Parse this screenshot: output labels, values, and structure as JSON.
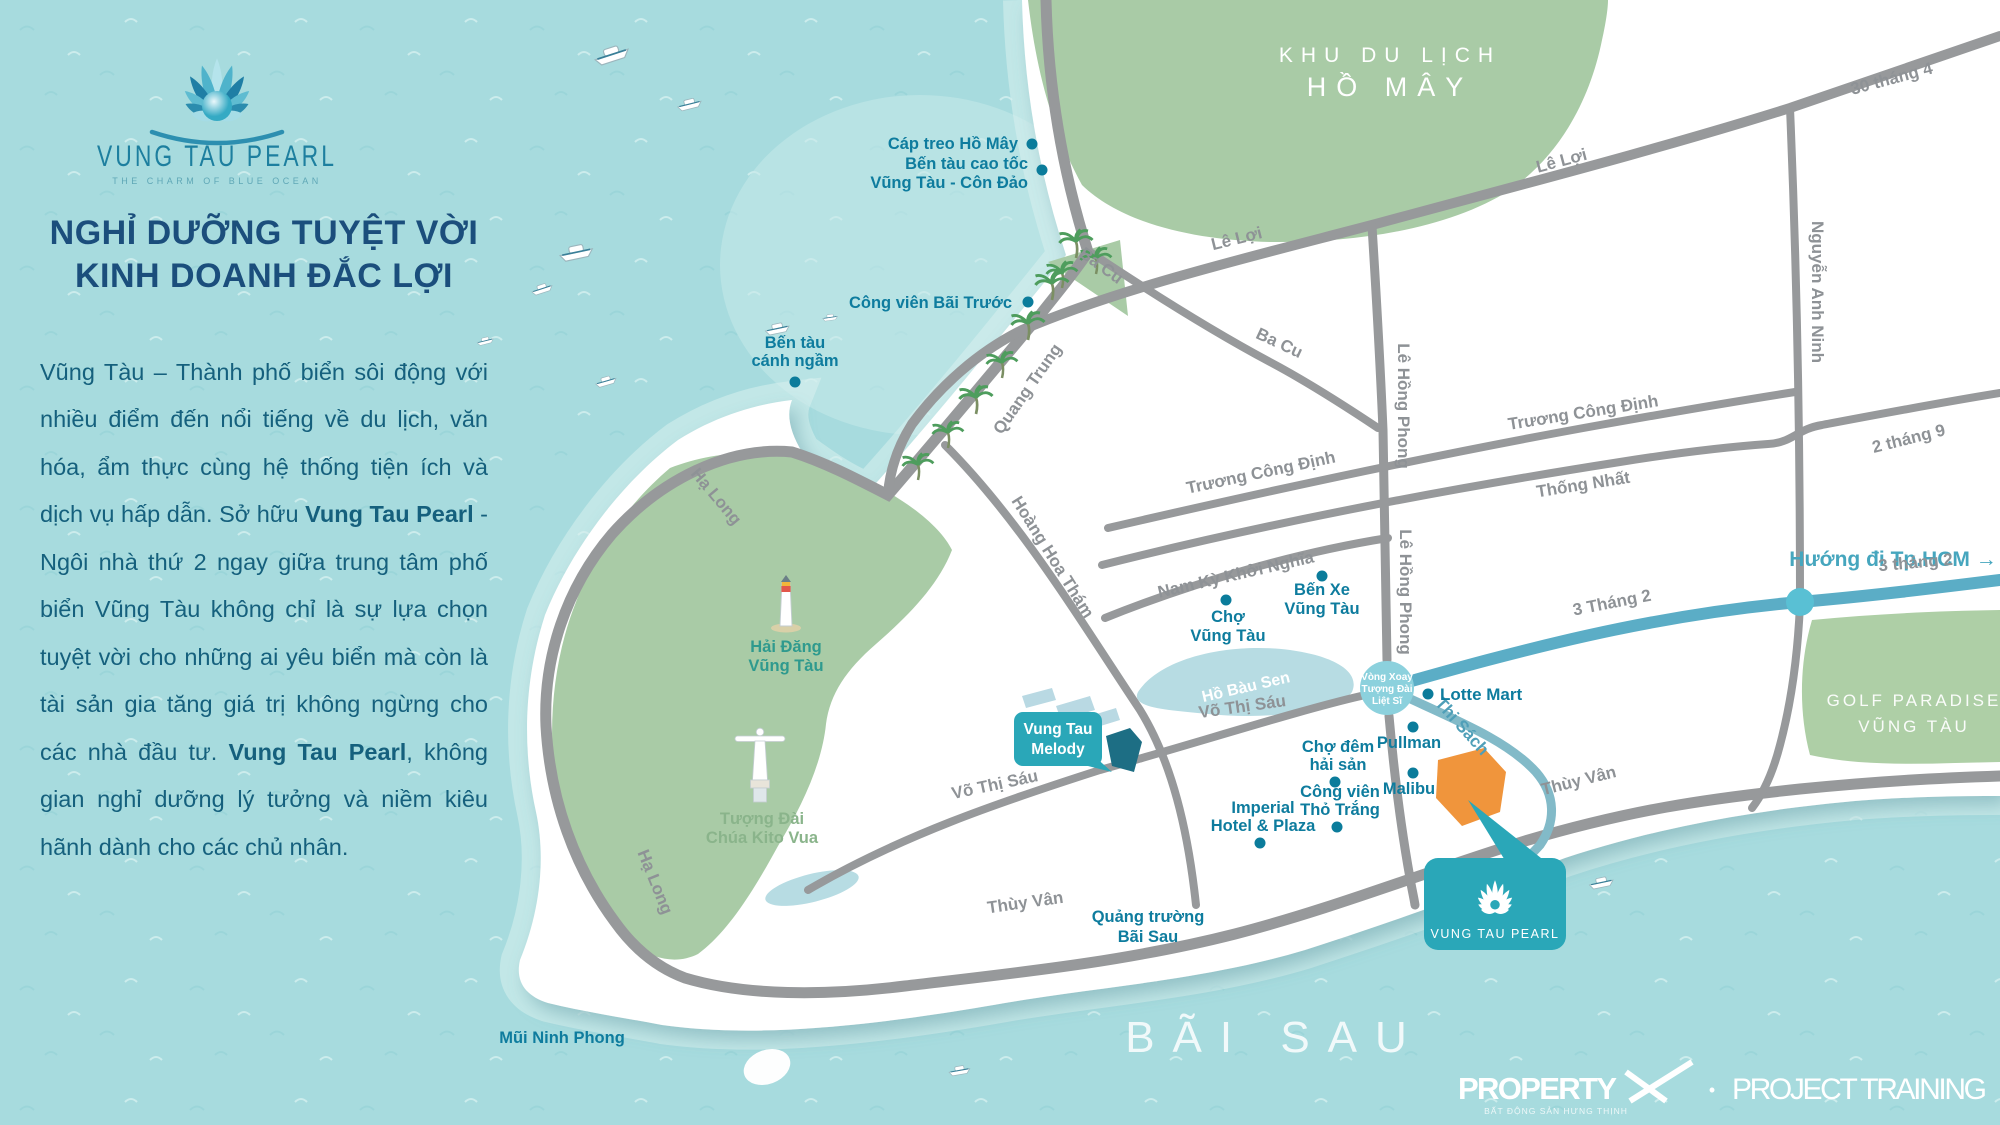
{
  "brand": {
    "logo_title": "VUNG TAU PEARL",
    "logo_tagline": "THE CHARM OF BLUE OCEAN"
  },
  "intro": {
    "heading_line1": "NGHỈ DƯỠNG TUYỆT VỜI",
    "heading_line2": "KINH DOANH ĐẮC LỢI",
    "paragraph": [
      {
        "text": "Vũng Tàu – Thành phố biển sôi động với nhiều điểm đến nổi tiếng về du lịch, văn hóa, ẩm thực cùng hệ thống tiện ích và dịch vụ hấp dẫn. Sở hữu ",
        "bold": false
      },
      {
        "text": "Vung Tau Pearl",
        "bold": true
      },
      {
        "text": " - Ngôi nhà thứ 2 ngay giữa trung tâm phố biển Vũng Tàu không chỉ là sự lựa chọn tuyệt vời cho những ai yêu biển mà còn là tài sản gia tăng giá trị không ngừng cho các nhà đầu tư. ",
        "bold": false
      },
      {
        "text": "Vung Tau Pearl",
        "bold": true
      },
      {
        "text": ", không gian nghỉ dưỡng lý tưởng và niềm kiêu hãnh dành cho các chủ nhân.",
        "bold": false
      }
    ]
  },
  "map": {
    "areas": {
      "khu_du_lich": "KHU DU LỊCH",
      "ho_may": "HỒ MÂY",
      "golf_line1": "GOLF PARADISE",
      "golf_line2": "VŨNG TÀU",
      "bai_sau": "BÃI SAU",
      "lake": "Hồ Bàu Sen",
      "direction_hcm": "Hướng đi Tp.HCM →",
      "cape": "Mũi Ninh Phong"
    },
    "roads": {
      "thang4_30": "30 tháng 4",
      "le_loi": "Lê Lợi",
      "ba_cu": "Ba Cu",
      "quang_trung": "Quang Trung",
      "ha_long": "Hạ Long",
      "le_hong_phong": "Lê Hồng Phong",
      "nguyen_anh_ninh": "Nguyễn Anh Ninh",
      "truong_cong_dinh": "Trương Công Định",
      "thong_nhat": "Thống Nhất",
      "thang9_2": "2 tháng 9",
      "nam_ky_khoi_nghia": "Nam Kỳ Khởi Nghĩa",
      "hoang_hoa_tham": "Hoàng Hoa Thám",
      "vo_thi_sau": "Võ Thị Sáu",
      "thuy_van": "Thùy Vân",
      "thi_sach": "Thi Sách",
      "thang2_3a": "3 Tháng 2",
      "thang2_3b": "3 tháng 2"
    },
    "pois": {
      "cap_treo": "Cáp treo Hồ Mây",
      "ben_tau_cao_toc_1": "Bến tàu cao tốc",
      "ben_tau_cao_toc_2": "Vũng Tàu - Côn Đảo",
      "cong_vien_bai_truoc": "Công viên Bãi Trước",
      "ben_tau_canh_ngam_1": "Bến tàu",
      "ben_tau_canh_ngam_2": "cánh ngầm",
      "hai_dang_1": "Hải Đăng",
      "hai_dang_2": "Vũng Tàu",
      "tuong_dai_1": "Tượng Đài",
      "tuong_dai_2": "Chúa Kito Vua",
      "cho_vt_1": "Chợ",
      "cho_vt_2": "Vũng Tàu",
      "ben_xe_1": "Bến Xe",
      "ben_xe_2": "Vũng Tàu",
      "lotte": "Lotte Mart",
      "pullman": "Pullman",
      "malibu": "Malibu",
      "cho_dem_1": "Chợ đêm",
      "cho_dem_2": "hải sản",
      "tho_trang_1": "Công viên",
      "tho_trang_2": "Thỏ Trắng",
      "imperial_1": "Imperial",
      "imperial_2": "Hotel & Plaza",
      "quang_truong_1": "Quảng trường",
      "quang_truong_2": "Bãi Sau",
      "melody_1": "Vung Tau",
      "melody_2": "Melody"
    },
    "roundabout": {
      "l1": "Vòng Xoay",
      "l2": "Tượng Đài",
      "l3": "Liệt Sĩ"
    },
    "site_callout": "VUNG TAU PEARL"
  },
  "footer": {
    "brand_word": "PROPERTY",
    "brand_x": "X",
    "brand_tagline": "BẤT ĐỘNG SẢN HƯNG THỊNH",
    "separator": "•",
    "label": "PROJECT TRAINING"
  },
  "colors": {
    "sea": "#a7dbde",
    "accent_teal": "#2aa7b8",
    "site_orange": "#f0953c",
    "road_gray": "#97999b",
    "road_blue": "#5badc6",
    "poi_teal": "#0e7c9e",
    "green_area": "#a9cba6",
    "heading_blue": "#1b4e7c"
  }
}
